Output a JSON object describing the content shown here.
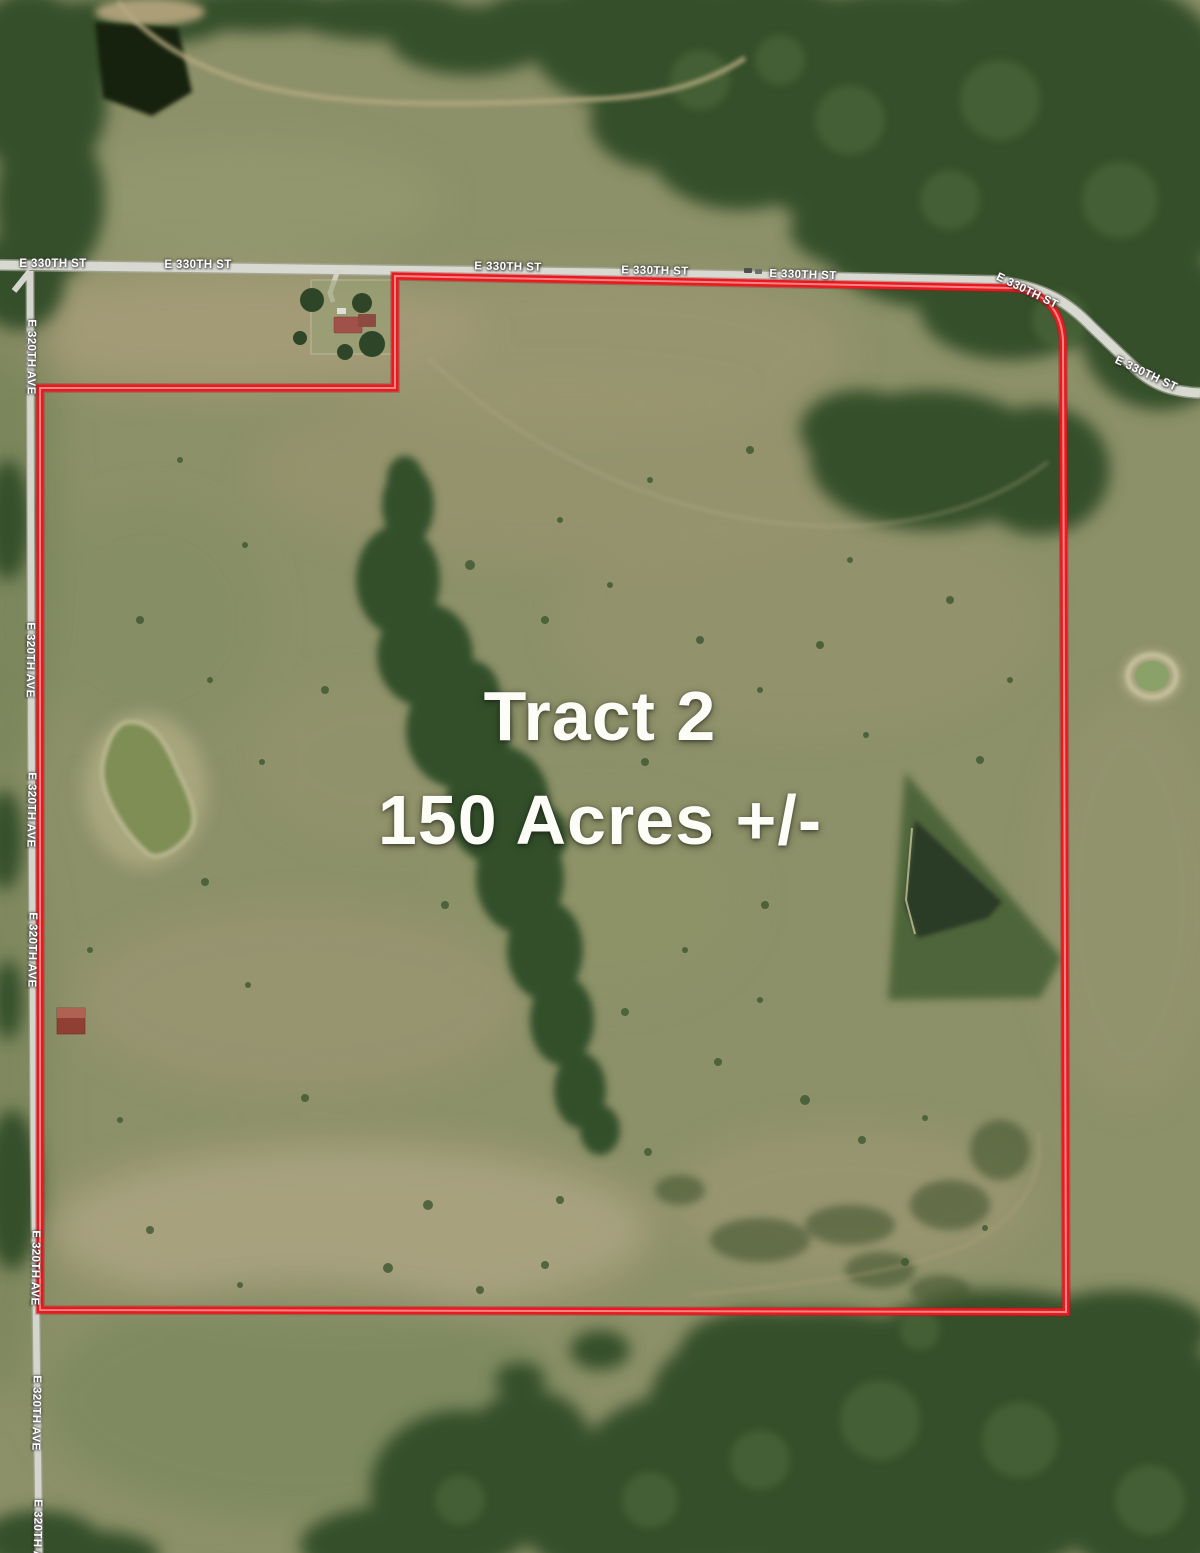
{
  "map": {
    "tract_label": {
      "title": "Tract 2",
      "acreage": "150 Acres +/-"
    },
    "road_labels": {
      "e330": "E 330TH ST",
      "e320": "E 320TH AVE"
    },
    "boundary": {
      "color": "#e8191f",
      "highlight_color": "#ff9090",
      "path": "M 40,388 L 395,388 L 395,276 L 1012,288 Q 1060,293 1063,340 L 1066,1312 L 40,1310 Z"
    },
    "colors": {
      "field_green": "#8d9169",
      "forest_green": "#35502b",
      "road_gray": "#d8d9d1",
      "pond_dark": "#16200f",
      "pond_green": "#7e8e55",
      "label_white": "#ffffff"
    }
  }
}
